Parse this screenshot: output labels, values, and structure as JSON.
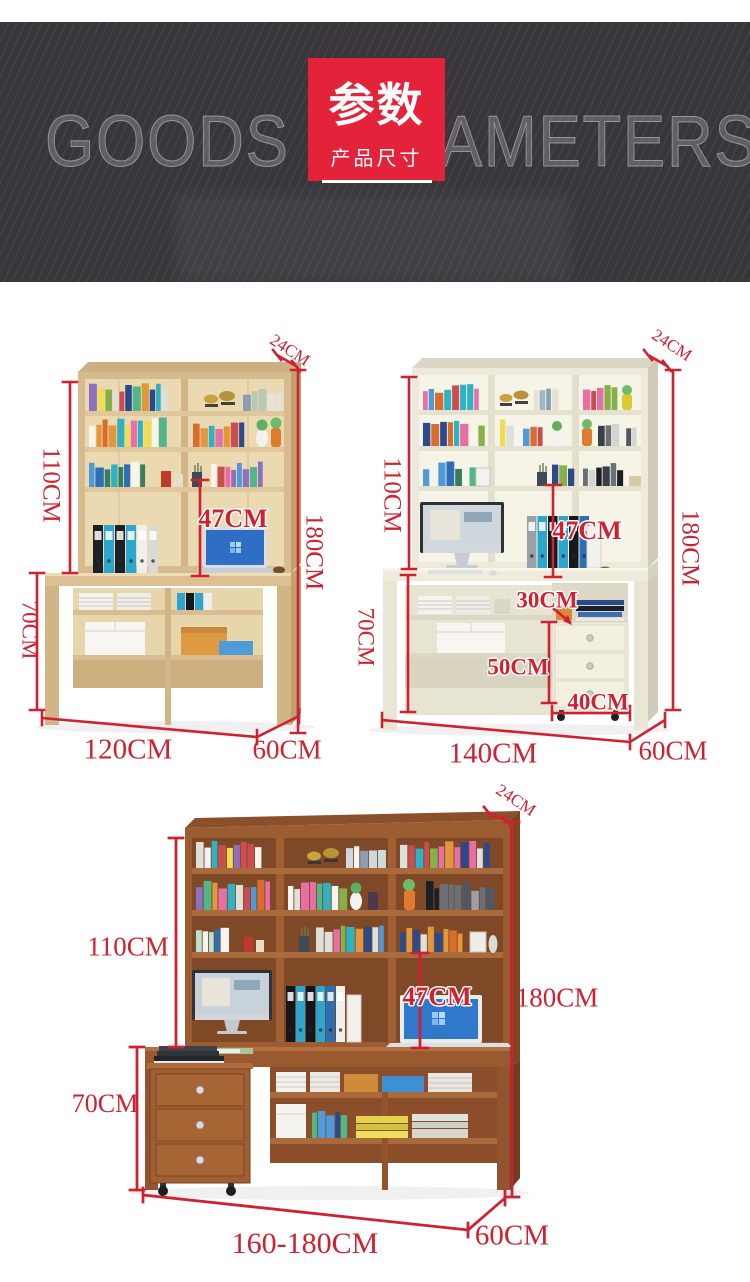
{
  "header": {
    "background_text": "GOODS PARAMETERS",
    "badge_title": "参数",
    "badge_subtitle": "产品尺寸"
  },
  "colors": {
    "dimension_red": "#cf2130",
    "badge_red": "#e4233b",
    "banner_dark": "#38363a",
    "wood_p1": "#d7bb8e",
    "wood_p2": "#edeadb",
    "wood_p3": "#9c5c31"
  },
  "products": [
    {
      "dims": {
        "top_depth": "24CM",
        "hutch_height": "110CM",
        "screen_height": "47CM",
        "total_height": "180CM",
        "desk_height": "70CM",
        "width": "120CM",
        "depth": "60CM"
      }
    },
    {
      "dims": {
        "top_depth": "24CM",
        "hutch_height": "110CM",
        "screen_height": "47CM",
        "total_height": "180CM",
        "desk_height": "70CM",
        "width": "140CM",
        "depth": "60CM",
        "cabinet_gap": "30CM",
        "cabinet_height": "50CM",
        "cabinet_width": "40CM"
      }
    },
    {
      "dims": {
        "top_depth": "24CM",
        "hutch_height": "110CM",
        "screen_height": "47CM",
        "total_height": "180CM",
        "desk_height": "70CM",
        "width": "160-180CM",
        "depth": "60CM"
      }
    }
  ]
}
